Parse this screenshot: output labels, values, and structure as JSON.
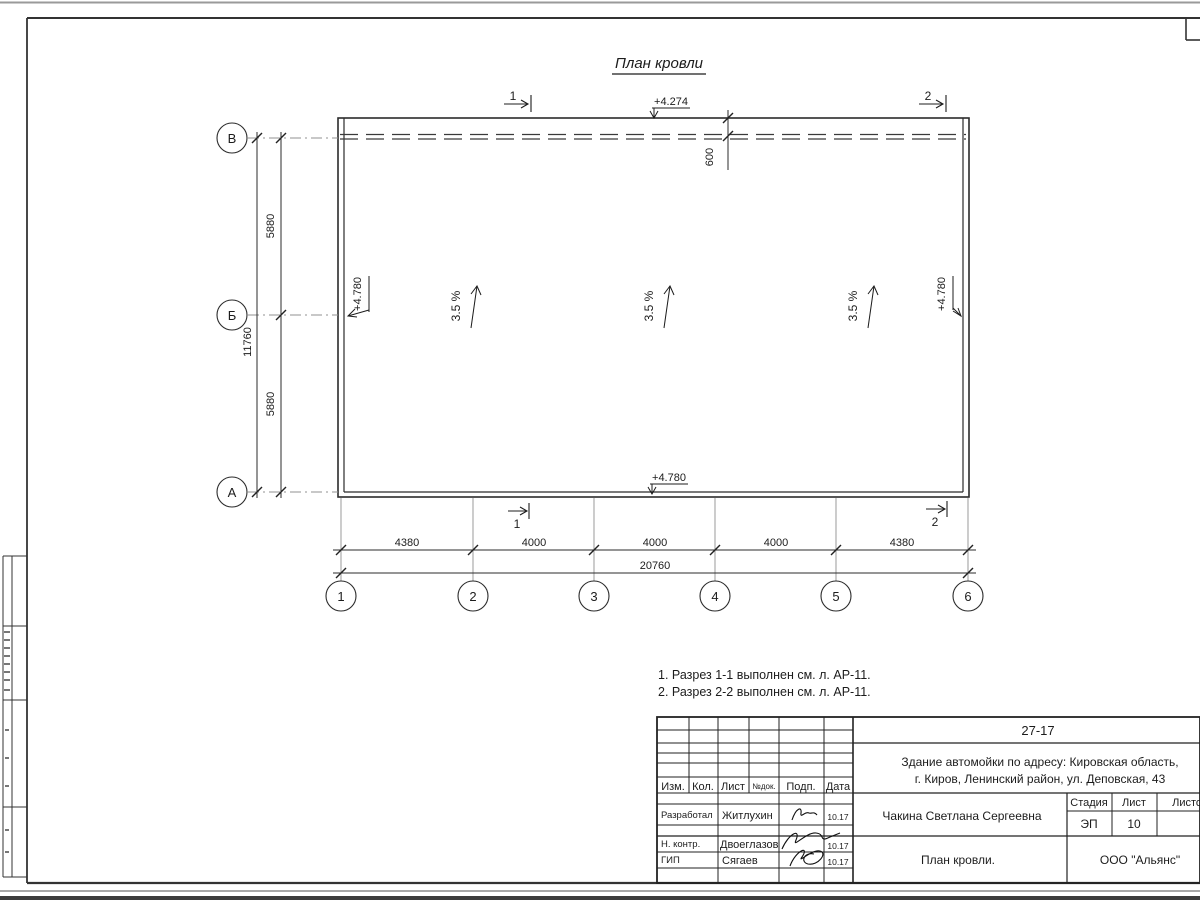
{
  "title": "План кровли",
  "plan": {
    "slope": "3.5 %",
    "parapet_offset": "600",
    "elevations": {
      "top": "+4.274",
      "left": "+4.780",
      "right": "+4.780",
      "bottom": "+4.780"
    },
    "section_marks": {
      "s1": "1",
      "s2": "2"
    }
  },
  "axes": {
    "bottom": [
      "1",
      "2",
      "3",
      "4",
      "5",
      "6"
    ],
    "left": [
      "В",
      "Б",
      "А"
    ]
  },
  "dimensions": {
    "bottom_segments": [
      "4380",
      "4000",
      "4000",
      "4000",
      "4380"
    ],
    "bottom_total": "20760",
    "left_segments": [
      "5880",
      "5880"
    ],
    "left_total": "11760"
  },
  "notes": [
    "1. Разрез 1-1 выполнен см. л. АР-11.",
    "2. Разрез 2-2 выполнен см. л. АР-11."
  ],
  "titleblock": {
    "doc_number": "27-17",
    "project_line1": "Здание автомойки по адресу: Кировская область,",
    "project_line2": "г. Киров, Ленинский район, ул. Деповская, 43",
    "client": "Чакина Светлана Сергеевна",
    "sheet_title": "План кровли.",
    "company": "ООО \"Альянс\"",
    "headers": {
      "izm": "Изм.",
      "kol": "Кол.",
      "list": "Лист",
      "ndok": "№док.",
      "podp": "Подп.",
      "data": "Дата",
      "stage": "Стадия",
      "sheet": "Лист",
      "sheets": "Листов"
    },
    "stage_value": "ЭП",
    "sheet_value": "10",
    "roles": [
      {
        "role": "Разработал",
        "name": "Житлухин",
        "date": "10.17"
      },
      {
        "role": "Н. контр.",
        "name": "Двоеглазов",
        "date": "10.17"
      },
      {
        "role": "ГИП",
        "name": "Сягаев",
        "date": "10.17"
      }
    ]
  }
}
